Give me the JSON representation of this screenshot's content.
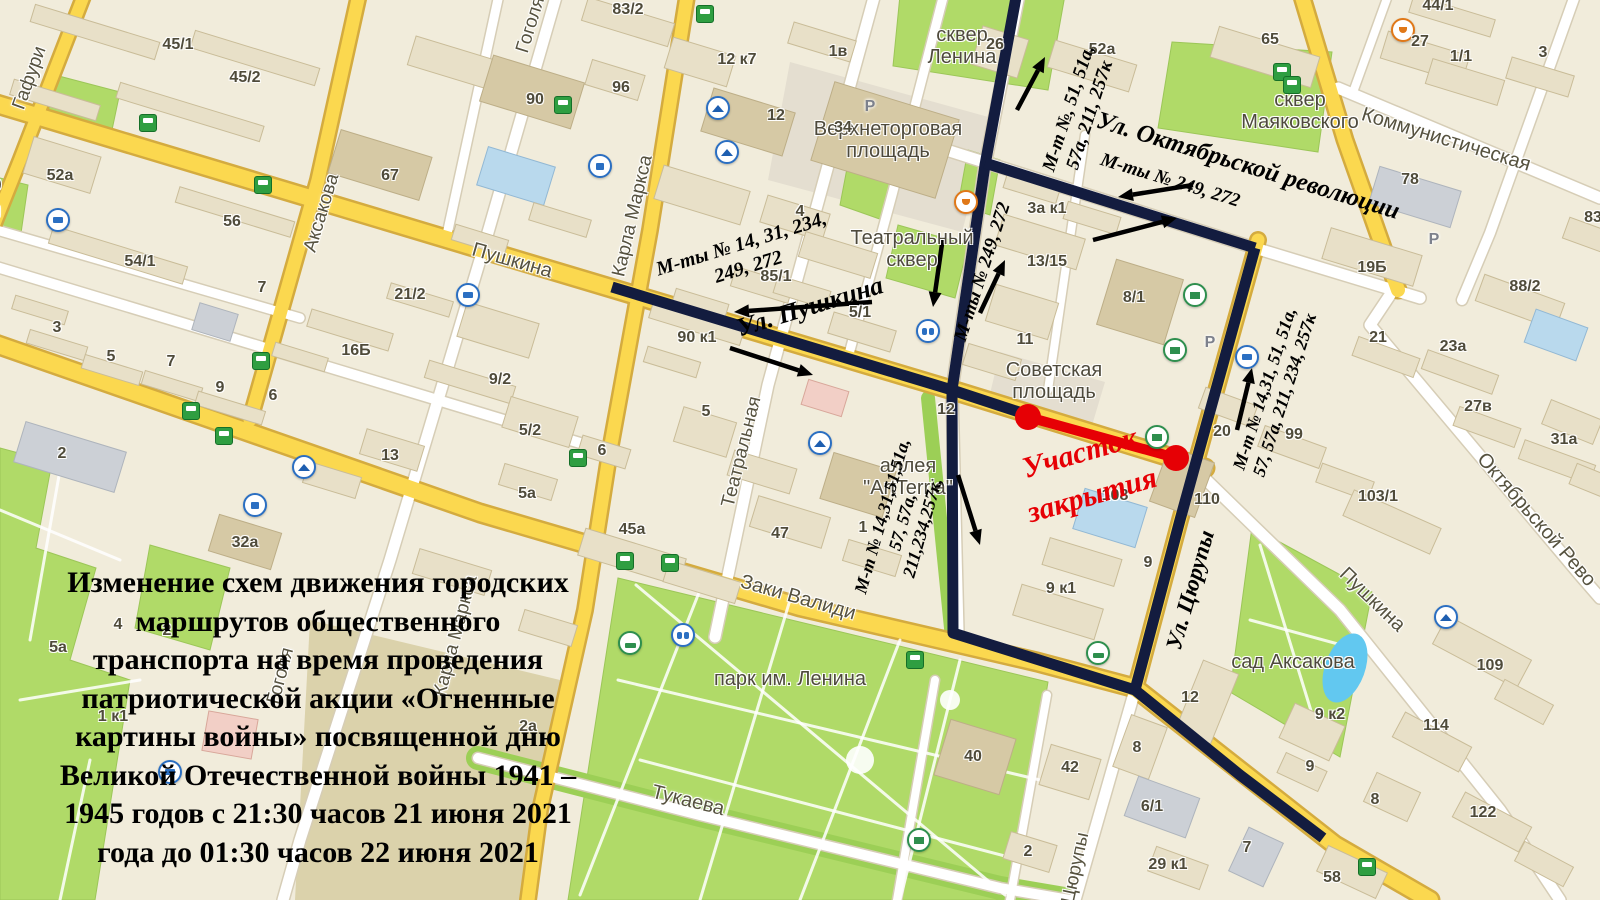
{
  "map_meta": {
    "width": 1600,
    "height": 900,
    "bg_color": "#f1ecdb",
    "route_color": "#131c3f",
    "closure_color": "#e60005",
    "road_yellow": "#fbd84f",
    "park_green": "#b0da68",
    "water_blue": "#62c8f0"
  },
  "notice": {
    "lines": [
      "Изменение схем движения городских",
      "маршрутов общественного",
      "транспорта на время проведения",
      "патриотической акции «Огненные",
      "картины войны» посвященной дню",
      "Великой Отечественной войны 1941 –",
      "1945 годов с 21:30 часов 21 июня 2021",
      "года до 01:30 часов 22 июня 2021"
    ]
  },
  "closure": {
    "segment": {
      "x1": 1028,
      "y1": 417,
      "x2": 1176,
      "y2": 458
    },
    "label": {
      "lines": [
        "Участок",
        "закрытия"
      ],
      "x": 1086,
      "y": 474,
      "rot": -16,
      "size": 30
    }
  },
  "routes": {
    "width": 11,
    "polylines": [
      [
        [
          612,
          287
        ],
        [
          952,
          390
        ],
        [
          1022,
          413
        ]
      ],
      [
        [
          1017,
          -8
        ],
        [
          985,
          165
        ],
        [
          952,
          390
        ]
      ],
      [
        [
          952,
          390
        ],
        [
          953,
          633
        ],
        [
          1135,
          690
        ],
        [
          1240,
          775
        ],
        [
          1323,
          838
        ]
      ],
      [
        [
          985,
          163
        ],
        [
          1255,
          248
        ]
      ],
      [
        [
          1255,
          248
        ],
        [
          1180,
          520
        ],
        [
          1135,
          690
        ]
      ]
    ]
  },
  "arrows": [
    [
      1017,
      110,
      1045,
      57
    ],
    [
      943,
      237,
      933,
      307
    ],
    [
      980,
      313,
      1005,
      260
    ],
    [
      1193,
      185,
      1118,
      197
    ],
    [
      1093,
      240,
      1177,
      218
    ],
    [
      872,
      302,
      734,
      312
    ],
    [
      730,
      348,
      813,
      375
    ],
    [
      1237,
      430,
      1252,
      368
    ],
    [
      958,
      475,
      980,
      545
    ]
  ],
  "route_annotations": [
    {
      "lines": [
        "М-ты № 14, 31, 234,",
        "249, 272"
      ],
      "x": 745,
      "y": 256,
      "rot": -17,
      "size": 20
    },
    {
      "lines": [
        "Ул. Пушкина"
      ],
      "x": 810,
      "y": 307,
      "rot": -17,
      "size": 26
    },
    {
      "lines": [
        "М-ты № 249, 272"
      ],
      "x": 983,
      "y": 272,
      "rot": -72,
      "size": 19
    },
    {
      "lines": [
        "М-т №, 51, 51а,",
        "57а, 211, 257к"
      ],
      "x": 1080,
      "y": 112,
      "rot": -72,
      "size": 19
    },
    {
      "lines": [
        "Ул. Октябрьской революции"
      ],
      "x": 1248,
      "y": 166,
      "rot": 17,
      "size": 25
    },
    {
      "lines": [
        "М-ты № 249, 272"
      ],
      "x": 1170,
      "y": 181,
      "rot": 17,
      "size": 19
    },
    {
      "lines": [
        "М-т № 14,31, 51, 51а,",
        "57, 57а, 211, 234, 257к"
      ],
      "x": 1275,
      "y": 392,
      "rot": -72,
      "size": 18
    },
    {
      "lines": [
        "М-т № 14,31,51,51а,",
        "57, 57а,",
        "211,234,257к,"
      ],
      "x": 903,
      "y": 522,
      "rot": -74,
      "size": 18
    },
    {
      "lines": [
        "Ул. Цюрупы"
      ],
      "x": 1190,
      "y": 590,
      "rot": -74,
      "size": 23
    }
  ],
  "street_labels": [
    {
      "text": "Гафури",
      "x": 30,
      "y": 78,
      "rot": -70,
      "size": 19
    },
    {
      "text": "Гафури",
      "x": -30,
      "y": 211,
      "rot": 0,
      "size": 18
    },
    {
      "text": "Аксакова",
      "x": 322,
      "y": 213,
      "rot": -73,
      "size": 19
    },
    {
      "text": "Гоголя",
      "x": 531,
      "y": 25,
      "rot": -73,
      "size": 19
    },
    {
      "text": "Карла Маркса",
      "x": 633,
      "y": 216,
      "rot": -77,
      "size": 19
    },
    {
      "text": "Пушкина",
      "x": 512,
      "y": 261,
      "rot": 16,
      "size": 20
    },
    {
      "text": "Театральная",
      "x": 742,
      "y": 452,
      "rot": -76,
      "size": 19
    },
    {
      "text": "Заки Валиди",
      "x": 798,
      "y": 598,
      "rot": 16,
      "size": 20
    },
    {
      "text": "Тукаева",
      "x": 688,
      "y": 801,
      "rot": 14,
      "size": 20
    },
    {
      "text": "Гоголя",
      "x": 281,
      "y": 676,
      "rot": -75,
      "size": 19
    },
    {
      "text": "Карла Маркса",
      "x": 456,
      "y": 636,
      "rot": -75,
      "size": 19
    },
    {
      "text": "Коммунистическая",
      "x": 1446,
      "y": 140,
      "rot": 17,
      "size": 20
    },
    {
      "text": "Октябрьской Рево",
      "x": 1536,
      "y": 520,
      "rot": 49,
      "size": 20
    },
    {
      "text": "Пушкина",
      "x": 1372,
      "y": 600,
      "rot": 44,
      "size": 20
    },
    {
      "text": "Цюрупы",
      "x": 1076,
      "y": 868,
      "rot": -78,
      "size": 19
    }
  ],
  "place_labels": [
    {
      "lines": [
        "сквер",
        "Ленина"
      ],
      "x": 962,
      "y": 46
    },
    {
      "lines": [
        "Верхнеторговая",
        "площадь"
      ],
      "x": 888,
      "y": 140
    },
    {
      "lines": [
        "Театральный",
        "сквер"
      ],
      "x": 912,
      "y": 249
    },
    {
      "lines": [
        "сквер",
        "Маяковского"
      ],
      "x": 1300,
      "y": 111
    },
    {
      "lines": [
        "Советская",
        "площадь"
      ],
      "x": 1054,
      "y": 381
    },
    {
      "lines": [
        "аллея",
        "\"ArtTerria\""
      ],
      "x": 908,
      "y": 477
    },
    {
      "lines": [
        "парк им. Ленина"
      ],
      "x": 790,
      "y": 679
    },
    {
      "lines": [
        "сад Аксакова"
      ],
      "x": 1293,
      "y": 662
    },
    {
      "lines": [
        "сквер"
      ],
      "x": -24,
      "y": 184
    }
  ],
  "building_numbers": [
    {
      "t": "45/1",
      "x": 178,
      "y": 45
    },
    {
      "t": "45/2",
      "x": 245,
      "y": 78
    },
    {
      "t": "52а",
      "x": 60,
      "y": 176
    },
    {
      "t": "56",
      "x": 232,
      "y": 222
    },
    {
      "t": "54/1",
      "x": 140,
      "y": 262
    },
    {
      "t": "67",
      "x": 390,
      "y": 176
    },
    {
      "t": "90",
      "x": 535,
      "y": 100
    },
    {
      "t": "96",
      "x": 621,
      "y": 88
    },
    {
      "t": "83/2",
      "x": 628,
      "y": 10
    },
    {
      "t": "12 к7",
      "x": 737,
      "y": 60
    },
    {
      "t": "12",
      "x": 776,
      "y": 116
    },
    {
      "t": "1в",
      "x": 838,
      "y": 52
    },
    {
      "t": "4",
      "x": 800,
      "y": 212
    },
    {
      "t": "26",
      "x": 995,
      "y": 45
    },
    {
      "t": "52а",
      "x": 1102,
      "y": 50
    },
    {
      "t": "65",
      "x": 1270,
      "y": 40
    },
    {
      "t": "27",
      "x": 1420,
      "y": 42
    },
    {
      "t": "1/1",
      "x": 1461,
      "y": 57
    },
    {
      "t": "3",
      "x": 1543,
      "y": 53
    },
    {
      "t": "44/1",
      "x": 1438,
      "y": 6
    },
    {
      "t": "78",
      "x": 1410,
      "y": 180
    },
    {
      "t": "19Б",
      "x": 1372,
      "y": 268
    },
    {
      "t": "88/2",
      "x": 1525,
      "y": 287
    },
    {
      "t": "83",
      "x": 1593,
      "y": 218
    },
    {
      "t": "21",
      "x": 1378,
      "y": 338
    },
    {
      "t": "23а",
      "x": 1453,
      "y": 347
    },
    {
      "t": "27в",
      "x": 1478,
      "y": 407
    },
    {
      "t": "31а",
      "x": 1564,
      "y": 440
    },
    {
      "t": "103/1",
      "x": 1378,
      "y": 497
    },
    {
      "t": "34",
      "x": 843,
      "y": 128
    },
    {
      "t": "7",
      "x": 262,
      "y": 288
    },
    {
      "t": "21/2",
      "x": 410,
      "y": 295
    },
    {
      "t": "16Б",
      "x": 356,
      "y": 351
    },
    {
      "t": "9/2",
      "x": 500,
      "y": 380
    },
    {
      "t": "6",
      "x": 273,
      "y": 396
    },
    {
      "t": "3",
      "x": 57,
      "y": 328
    },
    {
      "t": "5",
      "x": 111,
      "y": 357
    },
    {
      "t": "7",
      "x": 171,
      "y": 362
    },
    {
      "t": "9",
      "x": 220,
      "y": 388
    },
    {
      "t": "2",
      "x": 62,
      "y": 454
    },
    {
      "t": "32а",
      "x": 245,
      "y": 543
    },
    {
      "t": "5/2",
      "x": 530,
      "y": 431
    },
    {
      "t": "5а",
      "x": 527,
      "y": 494
    },
    {
      "t": "6",
      "x": 602,
      "y": 451
    },
    {
      "t": "13",
      "x": 390,
      "y": 456
    },
    {
      "t": "90 к1",
      "x": 697,
      "y": 338
    },
    {
      "t": "85/1",
      "x": 776,
      "y": 277
    },
    {
      "t": "5/1",
      "x": 860,
      "y": 313
    },
    {
      "t": "5",
      "x": 706,
      "y": 412
    },
    {
      "t": "12",
      "x": 946,
      "y": 410
    },
    {
      "t": "47",
      "x": 780,
      "y": 534
    },
    {
      "t": "1",
      "x": 863,
      "y": 528
    },
    {
      "t": "45а",
      "x": 632,
      "y": 530
    },
    {
      "t": "4",
      "x": 118,
      "y": 625
    },
    {
      "t": "2",
      "x": 167,
      "y": 631
    },
    {
      "t": "5а",
      "x": 58,
      "y": 648
    },
    {
      "t": "1 к1",
      "x": 113,
      "y": 717
    },
    {
      "t": "2а",
      "x": 528,
      "y": 727
    },
    {
      "t": "40",
      "x": 973,
      "y": 757
    },
    {
      "t": "42",
      "x": 1070,
      "y": 768
    },
    {
      "t": "2",
      "x": 1028,
      "y": 852
    },
    {
      "t": "8",
      "x": 1137,
      "y": 748
    },
    {
      "t": "6/1",
      "x": 1152,
      "y": 807
    },
    {
      "t": "29 к1",
      "x": 1168,
      "y": 865
    },
    {
      "t": "7",
      "x": 1247,
      "y": 848
    },
    {
      "t": "9 к1",
      "x": 1061,
      "y": 589
    },
    {
      "t": "9",
      "x": 1148,
      "y": 563
    },
    {
      "t": "11",
      "x": 1025,
      "y": 340
    },
    {
      "t": "13/15",
      "x": 1047,
      "y": 262
    },
    {
      "t": "3а к1",
      "x": 1047,
      "y": 209
    },
    {
      "t": "8/1",
      "x": 1134,
      "y": 298
    },
    {
      "t": "108",
      "x": 1115,
      "y": 496
    },
    {
      "t": "110",
      "x": 1207,
      "y": 500
    },
    {
      "t": "20",
      "x": 1222,
      "y": 432
    },
    {
      "t": "99",
      "x": 1294,
      "y": 435
    },
    {
      "t": "109",
      "x": 1490,
      "y": 666
    },
    {
      "t": "114",
      "x": 1436,
      "y": 726
    },
    {
      "t": "122",
      "x": 1483,
      "y": 813
    },
    {
      "t": "58",
      "x": 1332,
      "y": 878
    },
    {
      "t": "8",
      "x": 1375,
      "y": 800
    },
    {
      "t": "9",
      "x": 1310,
      "y": 767
    },
    {
      "t": "9 к2",
      "x": 1330,
      "y": 715
    },
    {
      "t": "12",
      "x": 1190,
      "y": 698
    }
  ],
  "poi": [
    {
      "type": "bus",
      "x": 148,
      "y": 123
    },
    {
      "type": "bus",
      "x": 263,
      "y": 185
    },
    {
      "type": "bus",
      "x": 261,
      "y": 361
    },
    {
      "type": "bus",
      "x": 191,
      "y": 411
    },
    {
      "type": "bus",
      "x": 224,
      "y": 436
    },
    {
      "type": "bus",
      "x": 563,
      "y": 105
    },
    {
      "type": "bus",
      "x": 705,
      "y": 14
    },
    {
      "type": "bus",
      "x": 578,
      "y": 458
    },
    {
      "type": "bus",
      "x": 625,
      "y": 561
    },
    {
      "type": "bus",
      "x": 670,
      "y": 563
    },
    {
      "type": "bus",
      "x": 915,
      "y": 660
    },
    {
      "type": "bus",
      "x": 1282,
      "y": 72
    },
    {
      "type": "bus",
      "x": 1292,
      "y": 85
    },
    {
      "type": "bus",
      "x": 1367,
      "y": 867
    },
    {
      "type": "trolley",
      "x": 58,
      "y": 220
    },
    {
      "type": "trolley",
      "x": 468,
      "y": 295
    },
    {
      "type": "trolley",
      "x": 1247,
      "y": 357
    },
    {
      "type": "trolley",
      "x": 170,
      "y": 772
    },
    {
      "type": "edu",
      "x": 718,
      "y": 108
    },
    {
      "type": "edu",
      "x": 727,
      "y": 152
    },
    {
      "type": "edu",
      "x": 304,
      "y": 467
    },
    {
      "type": "edu",
      "x": 820,
      "y": 443
    },
    {
      "type": "edu",
      "x": 1446,
      "y": 617
    },
    {
      "type": "cafe",
      "x": 966,
      "y": 202
    },
    {
      "type": "cafe",
      "x": 1403,
      "y": 30
    },
    {
      "type": "museum",
      "x": 1157,
      "y": 437
    },
    {
      "type": "museum",
      "x": 1175,
      "y": 350
    },
    {
      "type": "museum",
      "x": 1195,
      "y": 295
    },
    {
      "type": "museum",
      "x": 919,
      "y": 840
    },
    {
      "type": "hotel",
      "x": 630,
      "y": 643
    },
    {
      "type": "hotel",
      "x": 1098,
      "y": 653
    },
    {
      "type": "theater",
      "x": 928,
      "y": 331
    },
    {
      "type": "theater",
      "x": 683,
      "y": 635
    },
    {
      "type": "parking",
      "x": 870,
      "y": 107
    },
    {
      "type": "parking",
      "x": 1210,
      "y": 343
    },
    {
      "type": "parking",
      "x": 1434,
      "y": 240
    },
    {
      "type": "shopping",
      "x": 600,
      "y": 166
    },
    {
      "type": "shopping",
      "x": 255,
      "y": 505
    }
  ]
}
